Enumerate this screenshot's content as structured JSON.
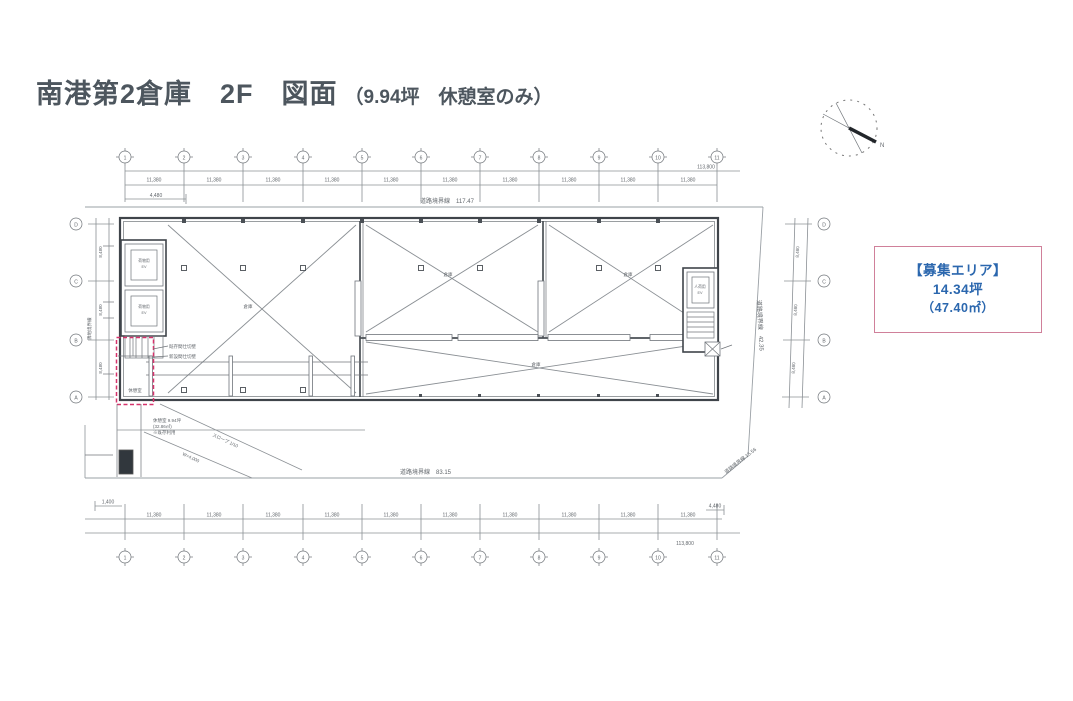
{
  "page": {
    "title_main": "南港第2倉庫　2F　図面",
    "title_sub": "（9.94坪　休憩室のみ）"
  },
  "info_box": {
    "line1": "【募集エリア】",
    "line2": "14.34坪",
    "line3": "（47.40㎡）"
  },
  "colors": {
    "accent_blue": "#2b67ae",
    "box_border_pink": "#d0809a",
    "highlight_pink": "#d6336c"
  },
  "compass": {
    "label": "N"
  },
  "plan": {
    "grid_cols": [
      "1",
      "2",
      "3",
      "4",
      "5",
      "6",
      "7",
      "8",
      "9",
      "10",
      "11"
    ],
    "grid_rows": [
      "D",
      "C",
      "B",
      "A"
    ],
    "boundaries": {
      "top": "道路境界線　117.47",
      "bottom": "道路境界線　83.15",
      "right": "道路境界線　42.35",
      "corner": "道路境界線 15.56",
      "left": "隣地境界線"
    },
    "dims": {
      "bay": "11,380",
      "total": "113,800",
      "sub_left": "4,480",
      "sub_left2": "1,400",
      "depth": [
        "8,480",
        "8,480",
        "8,480"
      ]
    },
    "rooms": {
      "warehouse": "倉庫",
      "ev_left": "荷物用",
      "ev_right": "人荷用",
      "ev": "EV",
      "break_room": "休憩室"
    },
    "notes": {
      "leader1": "既存間仕切壁",
      "leader2": "新設間仕切壁",
      "note_lines": [
        "休憩室 9.94坪",
        "(32.86㎡)",
        "※既存利用"
      ],
      "ramp1": "スロープ 1/10",
      "ramp2": "W=4,000"
    }
  }
}
